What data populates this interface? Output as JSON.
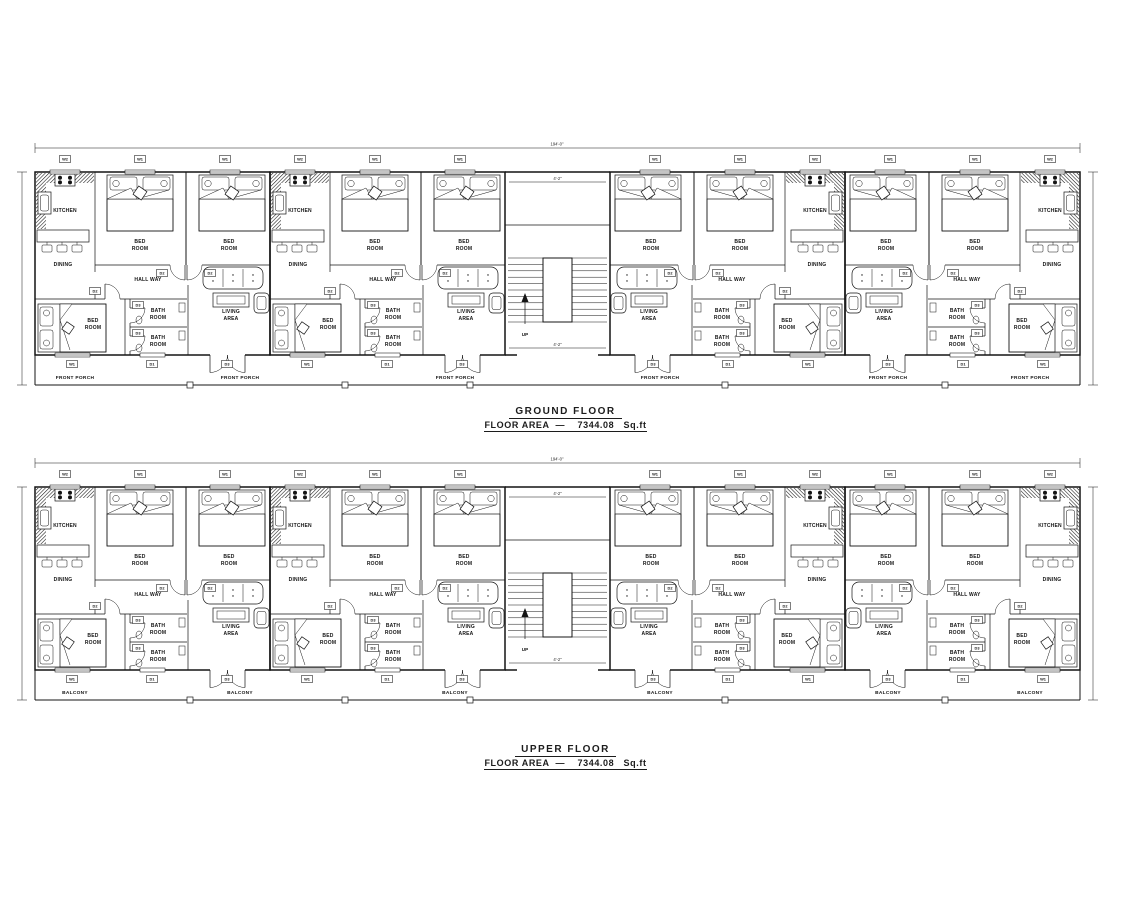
{
  "drawing": {
    "type": "residential apartment floor plans",
    "sheet_background": "#ffffff",
    "line_color": "#141414"
  },
  "floors": [
    {
      "title": "GROUND FLOOR",
      "area_label": "FLOOR AREA  —",
      "area_value": "7344.08",
      "area_unit": "Sq.ft",
      "porch_label": "FRONT PORCH"
    },
    {
      "title": "UPPER FLOOR",
      "area_label": "FLOOR AREA  —",
      "area_value": "7344.08",
      "area_unit": "Sq.ft",
      "porch_label": "BALCONY"
    }
  ],
  "rooms": {
    "kitchen": "KITCHEN",
    "dining": "DINING",
    "hall": "HALL WAY",
    "bed_l1": "BED",
    "bed_l2": "ROOM",
    "bath_l1": "BATH",
    "bath_l2": "ROOM",
    "living_l1": "LIVING",
    "living_l2": "AREA"
  },
  "stair": {
    "up": "UP",
    "dim_top": "4'-2\"",
    "dim_bottom": "4'-2\""
  },
  "tags": {
    "w1": "W1",
    "w2": "W2",
    "d1": "D1",
    "d2": "D2",
    "d3": "D3"
  },
  "dims": {
    "overall": "194'-0\""
  }
}
